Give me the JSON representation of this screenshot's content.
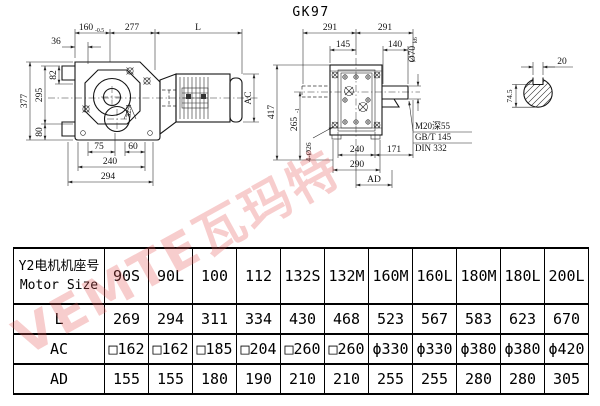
{
  "title": "GK97",
  "watermark_text": "VEMTE瓦玛特",
  "drawing": {
    "left_view": {
      "top": {
        "d160": "160",
        "d160_tol": "-0.5",
        "d277": "277",
        "dL": "L",
        "d36": "36"
      },
      "left": {
        "d377": "377",
        "d295": "295",
        "d80": "80",
        "d82": "82"
      },
      "bottom": {
        "d75": "75",
        "d60": "60",
        "d240": "240",
        "d294": "294"
      },
      "other": {
        "d32": "32.3",
        "dAC": "AC"
      }
    },
    "right_view": {
      "top": {
        "d291L": "291",
        "d291R": "291",
        "d145": "145",
        "d140": "140",
        "d70": "Ø70",
        "d70_fit": "k6"
      },
      "left": {
        "d417": "417",
        "d265": "265",
        "d265_tol": "-1",
        "d4o26": "4-Ø26"
      },
      "bottom": {
        "d240": "240",
        "d171": "171",
        "d290": "290",
        "dAD": "AD"
      },
      "notes": {
        "line1": "M20深55",
        "line2": "GB/T 145",
        "line3": "DIN 332"
      }
    },
    "shaft_detail": {
      "d20": "20",
      "d745": "74.5"
    }
  },
  "table": {
    "header": {
      "line1": "Y2电机机座号",
      "line2": "Motor Size"
    },
    "columns": [
      "90S",
      "90L",
      "100",
      "112",
      "132S",
      "132M",
      "160M",
      "160L",
      "180M",
      "180L",
      "200L"
    ],
    "rows": [
      {
        "label": "L",
        "values": [
          "269",
          "294",
          "311",
          "334",
          "430",
          "468",
          "523",
          "567",
          "583",
          "623",
          "670"
        ]
      },
      {
        "label": "AC",
        "values": [
          "□162",
          "□162",
          "□185",
          "□204",
          "□260",
          "□260",
          "ϕ330",
          "ϕ330",
          "ϕ380",
          "ϕ380",
          "ϕ420"
        ]
      },
      {
        "label": "AD",
        "values": [
          "155",
          "155",
          "180",
          "190",
          "210",
          "210",
          "255",
          "255",
          "280",
          "280",
          "305"
        ]
      }
    ]
  }
}
